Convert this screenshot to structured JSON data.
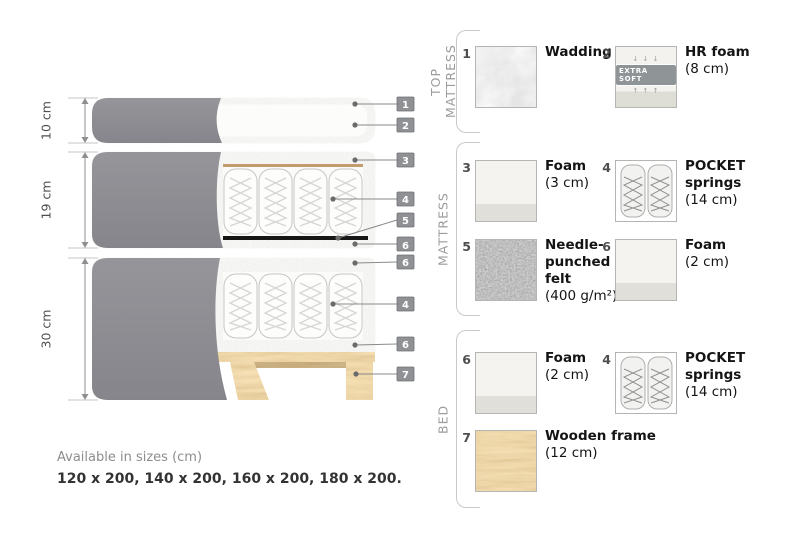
{
  "diagram": {
    "dimensions": [
      {
        "label": "10 cm"
      },
      {
        "label": "19 cm"
      },
      {
        "label": "30 cm"
      }
    ],
    "callouts": [
      {
        "number": "1"
      },
      {
        "number": "2"
      },
      {
        "number": "3"
      },
      {
        "number": "4"
      },
      {
        "number": "5"
      },
      {
        "number": "6"
      },
      {
        "number": "6"
      },
      {
        "number": "4"
      },
      {
        "number": "6"
      },
      {
        "number": "7"
      }
    ]
  },
  "legend": {
    "sections": [
      {
        "title": "TOP MATTRESS",
        "items": [
          {
            "number": "1",
            "name": "Wadding",
            "detail": ""
          },
          {
            "number": "2",
            "name": "HR foam",
            "detail": "(8 cm)",
            "badge": "EXTRA SOFT",
            "arrows_down": "↓ ↓ ↓",
            "arrows_up": "↑ ↑ ↑"
          }
        ]
      },
      {
        "title": "MATTRESS",
        "items": [
          {
            "number": "3",
            "name": "Foam",
            "detail": "(3 cm)"
          },
          {
            "number": "4",
            "name": "POCKET springs",
            "detail": "(14 cm)"
          },
          {
            "number": "5",
            "name": "Needle-punched felt",
            "detail": "(400 g/m²)"
          },
          {
            "number": "6",
            "name": "Foam",
            "detail": "(2 cm)"
          }
        ]
      },
      {
        "title": "BED",
        "items": [
          {
            "number": "6",
            "name": "Foam",
            "detail": "(2 cm)"
          },
          {
            "number": "4",
            "name": "POCKET springs",
            "detail": "(14 cm)"
          },
          {
            "number": "7",
            "name": "Wooden frame",
            "detail": "(12 cm)"
          }
        ]
      }
    ]
  },
  "footer": {
    "sizes_label": "Available in sizes (cm)",
    "sizes_value": "120 x 200, 140 x 200, 160 x 200, 180 x 200."
  },
  "colors": {
    "fabric_gray": "#8b8b90",
    "wood_tan": "#d9ac67",
    "badge_gray": "#8f9195",
    "felt_dark": "#5f5f5f"
  }
}
